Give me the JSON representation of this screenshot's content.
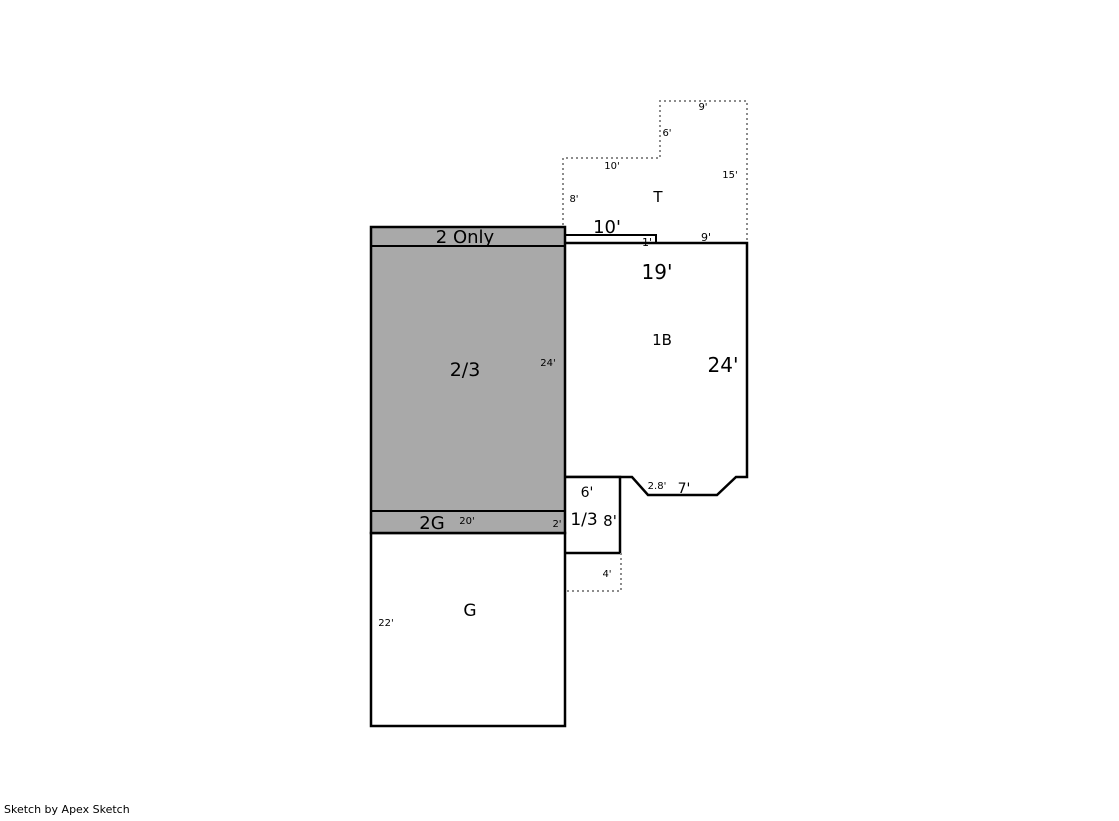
{
  "credit": "Sketch by Apex Sketch",
  "colors": {
    "background": "#FFFFFF",
    "area_fill": "#A9A9A9",
    "wall": "#000000",
    "dotted_line": "#8C8C8C"
  },
  "floorplan": {
    "attic": {
      "label": "T",
      "dim_top": "9'",
      "dim_step": "6'",
      "dim_upper": "10'",
      "dim_right": "15'",
      "dim_left": "8'"
    },
    "upper_strip": {
      "label": "2 Only"
    },
    "two_story": {
      "label": "2/3",
      "dim_right": "24'"
    },
    "garage_upper": {
      "label": "2G",
      "dim_width": "20'",
      "dim_height": "2'"
    },
    "garage": {
      "label": "G",
      "dim_left": "22'"
    },
    "one_b": {
      "label": "1B",
      "dim_strip_width": "10'",
      "dim_strip_height": "1'",
      "dim_top_right": "9'",
      "dim_width": "19'",
      "dim_height": "24'"
    },
    "bay": {
      "dim_diagonal": "2.8'",
      "dim_width": "7'"
    },
    "one_third": {
      "label": "1/3",
      "dim_width": "6'",
      "dim_height": "8'"
    },
    "stoop": {
      "dim_width": "4'"
    }
  }
}
